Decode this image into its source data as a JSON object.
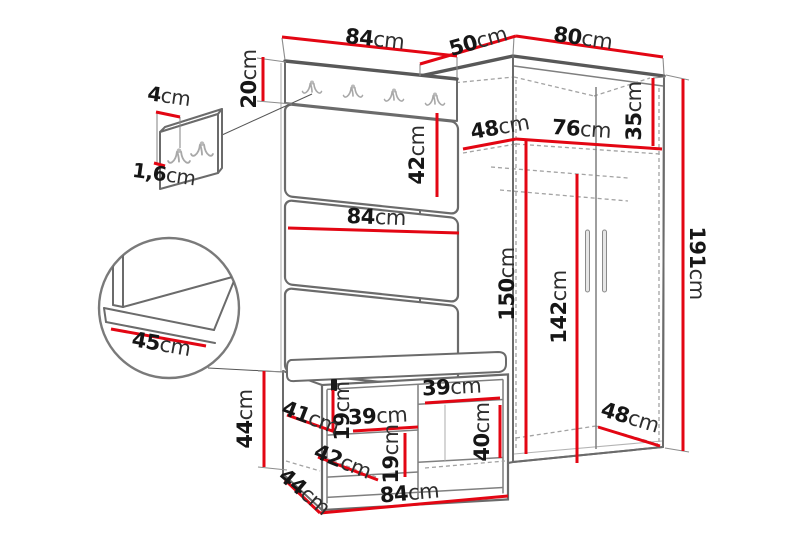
{
  "diagram": {
    "description_unit": "cm",
    "colors": {
      "dimension_line": "#e30613",
      "outline": "#6b6b6b",
      "hidden_line": "#a3a3a3",
      "text": "#161616",
      "background": "#ffffff"
    },
    "dims": {
      "hook_panel_width": {
        "v": "84",
        "u": "cm"
      },
      "hook_panel_height": {
        "v": "20",
        "u": "cm"
      },
      "hook_plate_height": {
        "v": "4",
        "u": "cm"
      },
      "hook_plate_thickness": {
        "v": "1,6",
        "u": "cm"
      },
      "wardrobe_top_depth": {
        "v": "50",
        "u": "cm"
      },
      "wardrobe_top_width": {
        "v": "80",
        "u": "cm"
      },
      "top_shelf_depth": {
        "v": "48",
        "u": "cm"
      },
      "top_shelf_width": {
        "v": "76",
        "u": "cm"
      },
      "top_shelf_height": {
        "v": "35",
        "u": "cm"
      },
      "wall_panel_height": {
        "v": "42",
        "u": "cm"
      },
      "wall_panel_width": {
        "v": "84",
        "u": "cm"
      },
      "seat_depth_detail": {
        "v": "45",
        "u": "cm"
      },
      "wardrobe_interior_height": {
        "v": "150",
        "u": "cm"
      },
      "door_height": {
        "v": "142",
        "u": "cm"
      },
      "wardrobe_height": {
        "v": "191",
        "u": "cm"
      },
      "bench_height": {
        "v": "44",
        "u": "cm"
      },
      "bench_upper_gap": {
        "v": "19",
        "u": "cm"
      },
      "bench_shelf_depth": {
        "v": "41",
        "u": "cm"
      },
      "bench_shelf_width": {
        "v": "39",
        "u": "cm"
      },
      "bench_lower_shelf_depth": {
        "v": "42",
        "u": "cm"
      },
      "bench_lower_gap": {
        "v": "19",
        "u": "cm"
      },
      "bench_depth": {
        "v": "44",
        "u": "cm"
      },
      "bench_width": {
        "v": "84",
        "u": "cm"
      },
      "bench_opening_width": {
        "v": "39",
        "u": "cm"
      },
      "bench_opening_height": {
        "v": "40",
        "u": "cm"
      },
      "wardrobe_bottom_depth": {
        "v": "48",
        "u": "cm"
      }
    }
  }
}
